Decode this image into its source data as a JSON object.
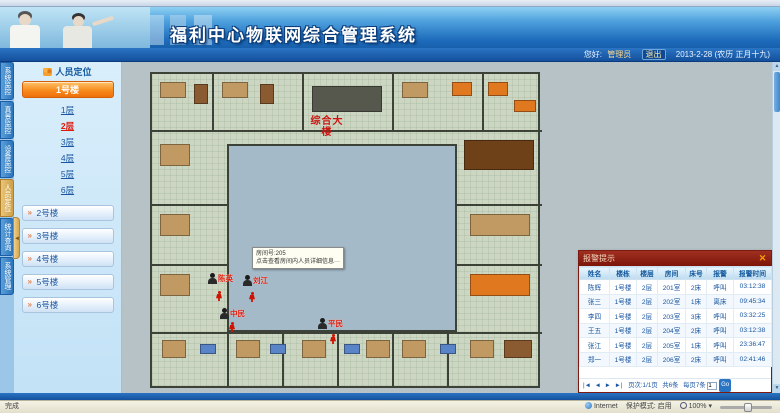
{
  "header": {
    "title": "福利中心物联网综合管理系统"
  },
  "userbar": {
    "greeting": "您好:",
    "username": "管理员",
    "logout_label": "退出",
    "date": "2013-2-28 (农历 正月十九)"
  },
  "sidebar": {
    "tabs": [
      {
        "label": "系统监控",
        "active": false
      },
      {
        "label": "真景监控",
        "active": false
      },
      {
        "label": "设备监控",
        "active": false
      },
      {
        "label": "人员定位",
        "active": true
      },
      {
        "label": "统计查询",
        "active": false
      },
      {
        "label": "系统管理",
        "active": false
      }
    ],
    "panel_title": "人员定位",
    "active_building": "1号楼",
    "floors": [
      {
        "label": "1层",
        "active": false
      },
      {
        "label": "2层",
        "active": true
      },
      {
        "label": "3层",
        "active": false
      },
      {
        "label": "4层",
        "active": false
      },
      {
        "label": "5层",
        "active": false
      },
      {
        "label": "6层",
        "active": false
      }
    ],
    "buildings": [
      "2号楼",
      "3号楼",
      "4号楼",
      "5号楼",
      "6号楼"
    ],
    "collapse_glyph": "◄"
  },
  "map": {
    "plan_label": "综合大楼",
    "tooltip": {
      "line1": "房间号:205",
      "line2": "点击查看房间内人员详细信息···"
    },
    "persons": [
      {
        "name": "陈英",
        "x": 208,
        "y": 273
      },
      {
        "name": "刘江",
        "x": 243,
        "y": 275
      },
      {
        "name": "中民",
        "x": 220,
        "y": 308
      },
      {
        "name": "平民",
        "x": 318,
        "y": 318
      }
    ],
    "figures": [
      {
        "x": 216,
        "y": 291
      },
      {
        "x": 249,
        "y": 292
      },
      {
        "x": 229,
        "y": 322
      },
      {
        "x": 330,
        "y": 334
      }
    ]
  },
  "popup": {
    "title": "报警提示",
    "close_glyph": "✕",
    "columns": [
      "姓名",
      "楼栋",
      "楼层",
      "房间",
      "床号",
      "报警",
      "报警时间"
    ],
    "rows": [
      {
        "cells": [
          "陈辉",
          "1号楼",
          "2层",
          "201室",
          "2床",
          "呼叫",
          "03:12:38"
        ],
        "alert": false
      },
      {
        "cells": [
          "张三",
          "1号楼",
          "2层",
          "202室",
          "1床",
          "离床",
          "09:45:34"
        ],
        "alert": true
      },
      {
        "cells": [
          "李四",
          "1号楼",
          "2层",
          "203室",
          "3床",
          "呼叫",
          "03:32:25"
        ],
        "alert": false
      },
      {
        "cells": [
          "王五",
          "1号楼",
          "2层",
          "204室",
          "2床",
          "呼叫",
          "03:12:38"
        ],
        "alert": false
      },
      {
        "cells": [
          "张江",
          "1号楼",
          "2层",
          "205室",
          "1床",
          "呼叫",
          "23:36:47"
        ],
        "alert": false
      },
      {
        "cells": [
          "郑一",
          "1号楼",
          "2层",
          "206室",
          "2床",
          "呼叫",
          "02:41:46"
        ],
        "alert": false
      }
    ],
    "pager": {
      "first": "|◄",
      "prev": "◄",
      "next": "►",
      "last": "►|",
      "page_info": "页次:1/1页",
      "total": "共6条",
      "per_page": "每页7条",
      "goto_value": "1",
      "go_label": "Go"
    }
  },
  "statusbar": {
    "left": "完成",
    "zone": "Internet",
    "protected_mode": "保护模式: 启用",
    "zoom": "100%"
  }
}
